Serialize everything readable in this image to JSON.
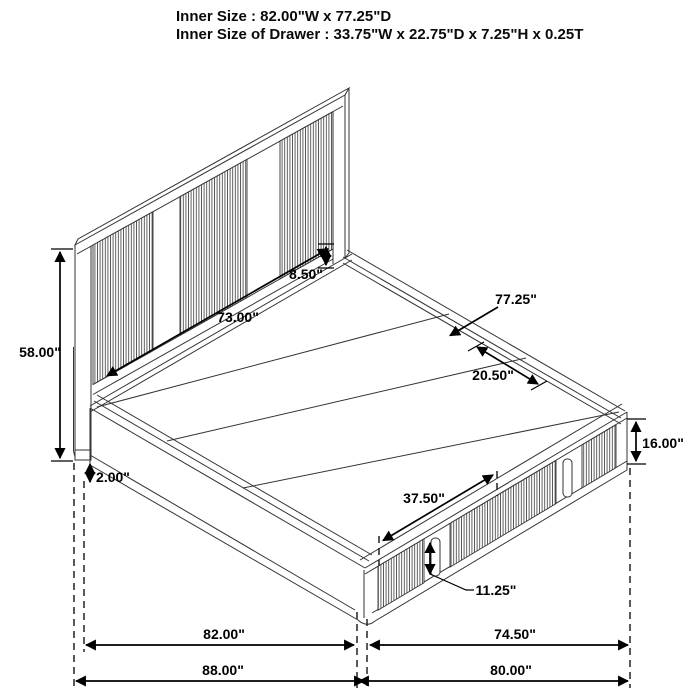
{
  "title_block": {
    "line1": "Inner Size : 82.00\"W x 77.25\"D",
    "line2": "Inner Size of Drawer : 33.75\"W x 22.75\"D x 7.25\"H x 0.25T"
  },
  "dimensions": {
    "headboard_height": "58.00\"",
    "plinth_height": "2.00\"",
    "headboard_inner_width": "73.00\"",
    "headboard_panel_gap": "8.50\"",
    "platform_depth": "77.25\"",
    "foot_clearance_depth": "20.50\"",
    "footboard_height": "16.00\"",
    "drawer_section_width": "37.50\"",
    "drawer_face_height": "11.25\"",
    "inner_width": "82.00\"",
    "drawer_side_depth": "74.50\"",
    "overall_width": "88.00\"",
    "overall_depth": "80.00\""
  },
  "colors": {
    "line": "#333333",
    "dimension": "#000000",
    "rib": "#4d4d4d",
    "background": "#ffffff"
  }
}
